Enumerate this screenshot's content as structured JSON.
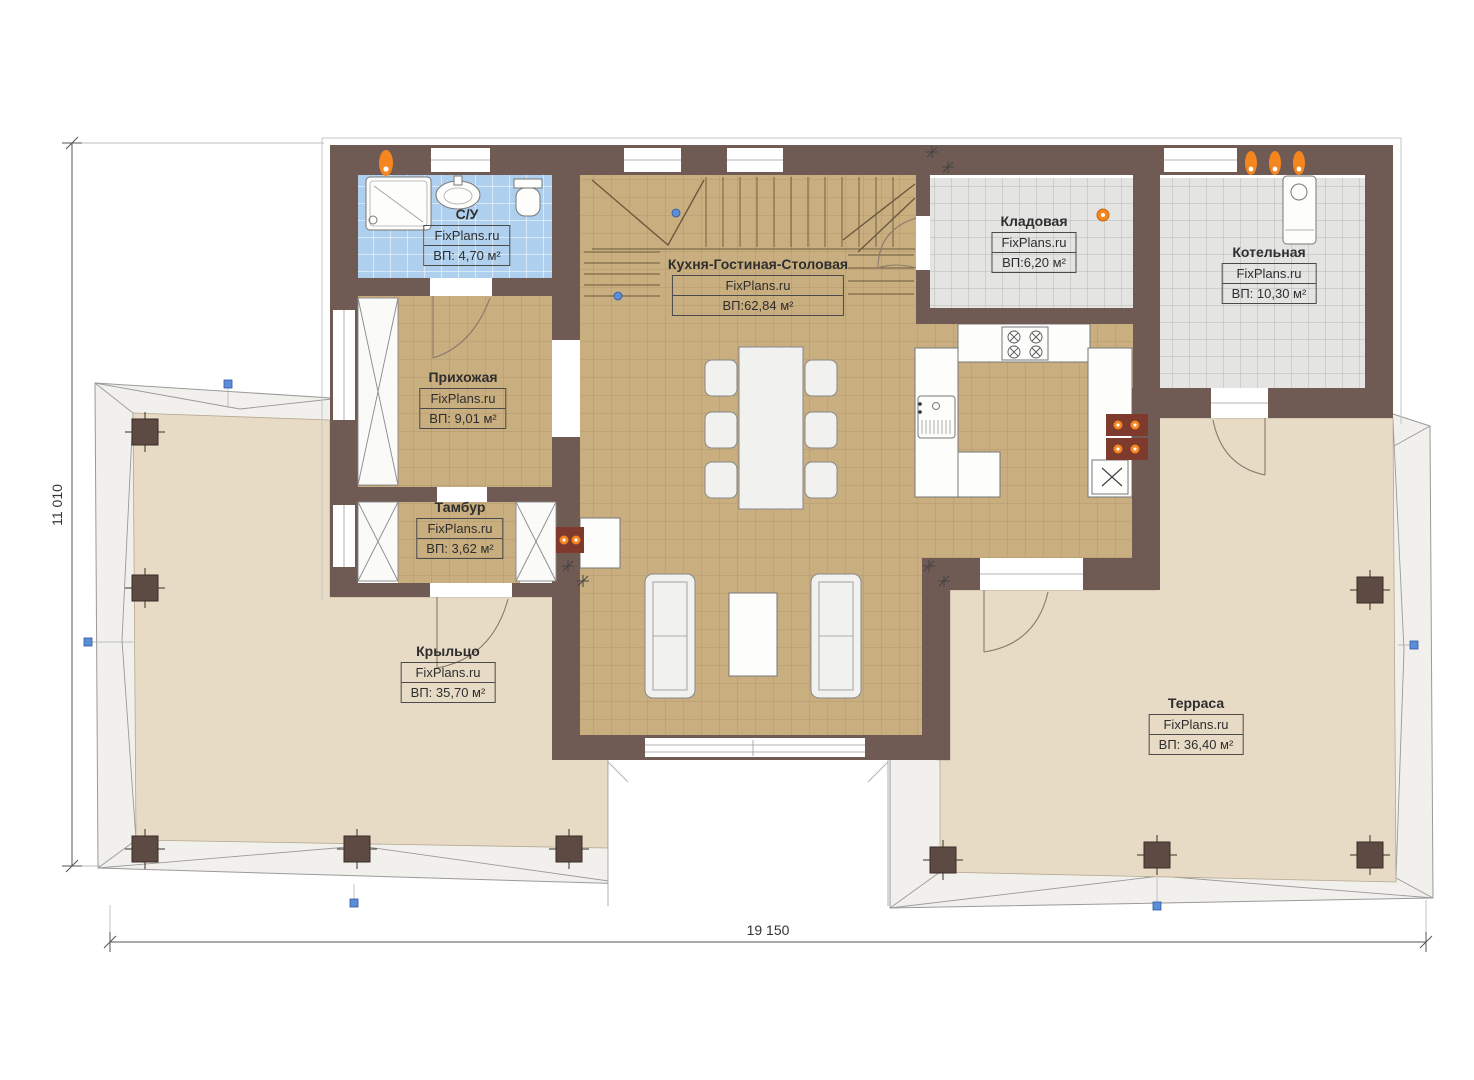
{
  "plan": {
    "brand": "FixPlans.ru",
    "dimensions": {
      "height_label": "11 010",
      "width_label": "19 150"
    },
    "rooms": [
      {
        "name": "С/У",
        "brand": "FixPlans.ru",
        "area": "ВП: 4,70 м²"
      },
      {
        "name": "Прихожая",
        "brand": "FixPlans.ru",
        "area": "ВП: 9,01 м²"
      },
      {
        "name": "Тамбур",
        "brand": "FixPlans.ru",
        "area": "ВП: 3,62 м²"
      },
      {
        "name": "Кухня-Гостиная-Столовая",
        "brand": "FixPlans.ru",
        "area": "ВП:62,84 м²"
      },
      {
        "name": "Кладовая",
        "brand": "FixPlans.ru",
        "area": "ВП:6,20 м²"
      },
      {
        "name": "Котельная",
        "brand": "FixPlans.ru",
        "area": "ВП: 10,30 м²"
      },
      {
        "name": "Крыльцо",
        "brand": "FixPlans.ru",
        "area": "ВП: 35,70 м²"
      },
      {
        "name": "Терраса",
        "brand": "FixPlans.ru",
        "area": "ВП: 36,40 м²"
      }
    ],
    "colors": {
      "wall": "#6f5a54",
      "tan": "#c9ae80",
      "tanline": "#b2986c",
      "blue": "#aed0ee",
      "gray": "#e4e4e3",
      "deck": "#e7dbc6",
      "roof": "#f1f0ec",
      "orange": "#f5861f",
      "handle": "#5b8dd9"
    }
  }
}
